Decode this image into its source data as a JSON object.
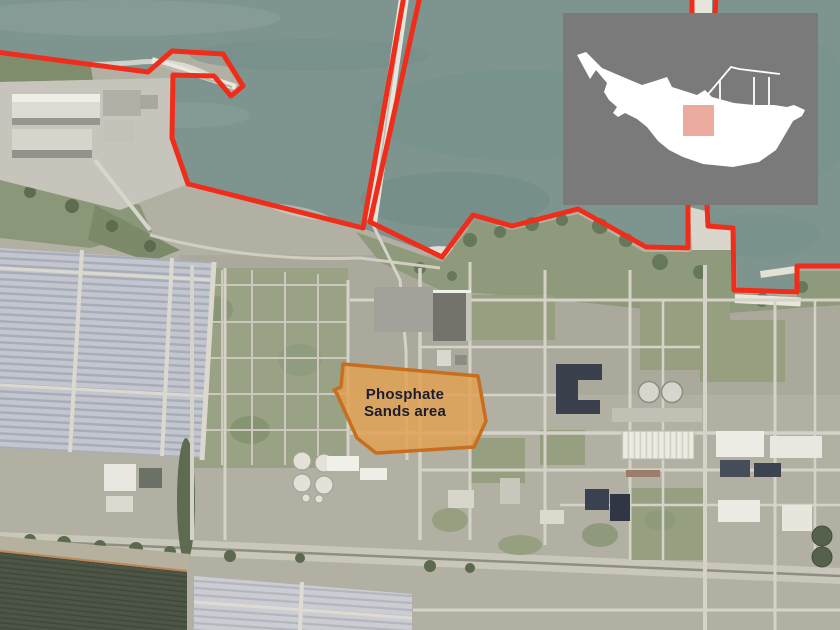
{
  "annotation": {
    "area_label": {
      "line1": "Phosphate",
      "line2": "Sands area"
    },
    "colors": {
      "boundary_red": "#ef2d1a",
      "area_fill": "#e2a052",
      "area_stroke": "#c86e1e",
      "label_text": "#1c1c2e"
    }
  },
  "inset_map": {
    "background_color": "#7a7a7a",
    "island_color": "#ffffff",
    "marker_color": "#ecab9f"
  }
}
